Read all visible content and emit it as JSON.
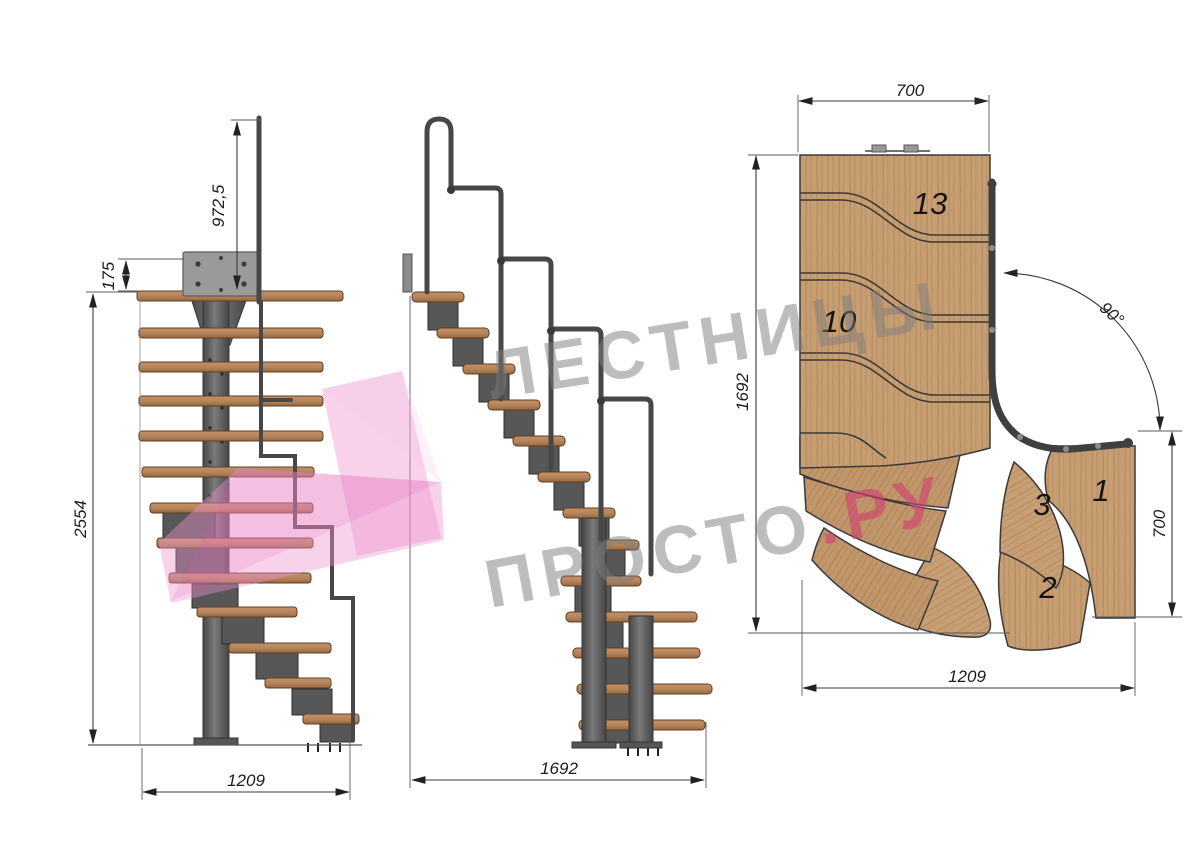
{
  "watermark": {
    "line1": "ЛЕСТНИЦЫ",
    "line2": "ПРОСТО",
    "line2_suffix": ".РУ"
  },
  "front_view": {
    "dim_rail_height": "972,5",
    "dim_plate_offset": "175",
    "dim_total_height": "2554",
    "dim_width": "1209"
  },
  "side_view": {
    "dim_length": "1692"
  },
  "plan_view": {
    "dim_top_width": "700",
    "dim_depth": "1692",
    "dim_bottom_width": "1209",
    "dim_right_depth": "700",
    "dim_turn_angle": "90°",
    "steps": [
      "13",
      "10",
      "3",
      "1",
      "2"
    ]
  },
  "colors": {
    "wood": "#c49a6e",
    "wood_dark": "#a87f54",
    "metal": "#575757",
    "metal_dark": "#353535",
    "dimension_line": "#3a3a3a",
    "watermark_gray": "#7e7e7e",
    "watermark_pink": "#d23f72",
    "logo_pink": "#ee93d0",
    "background": "#ffffff"
  }
}
